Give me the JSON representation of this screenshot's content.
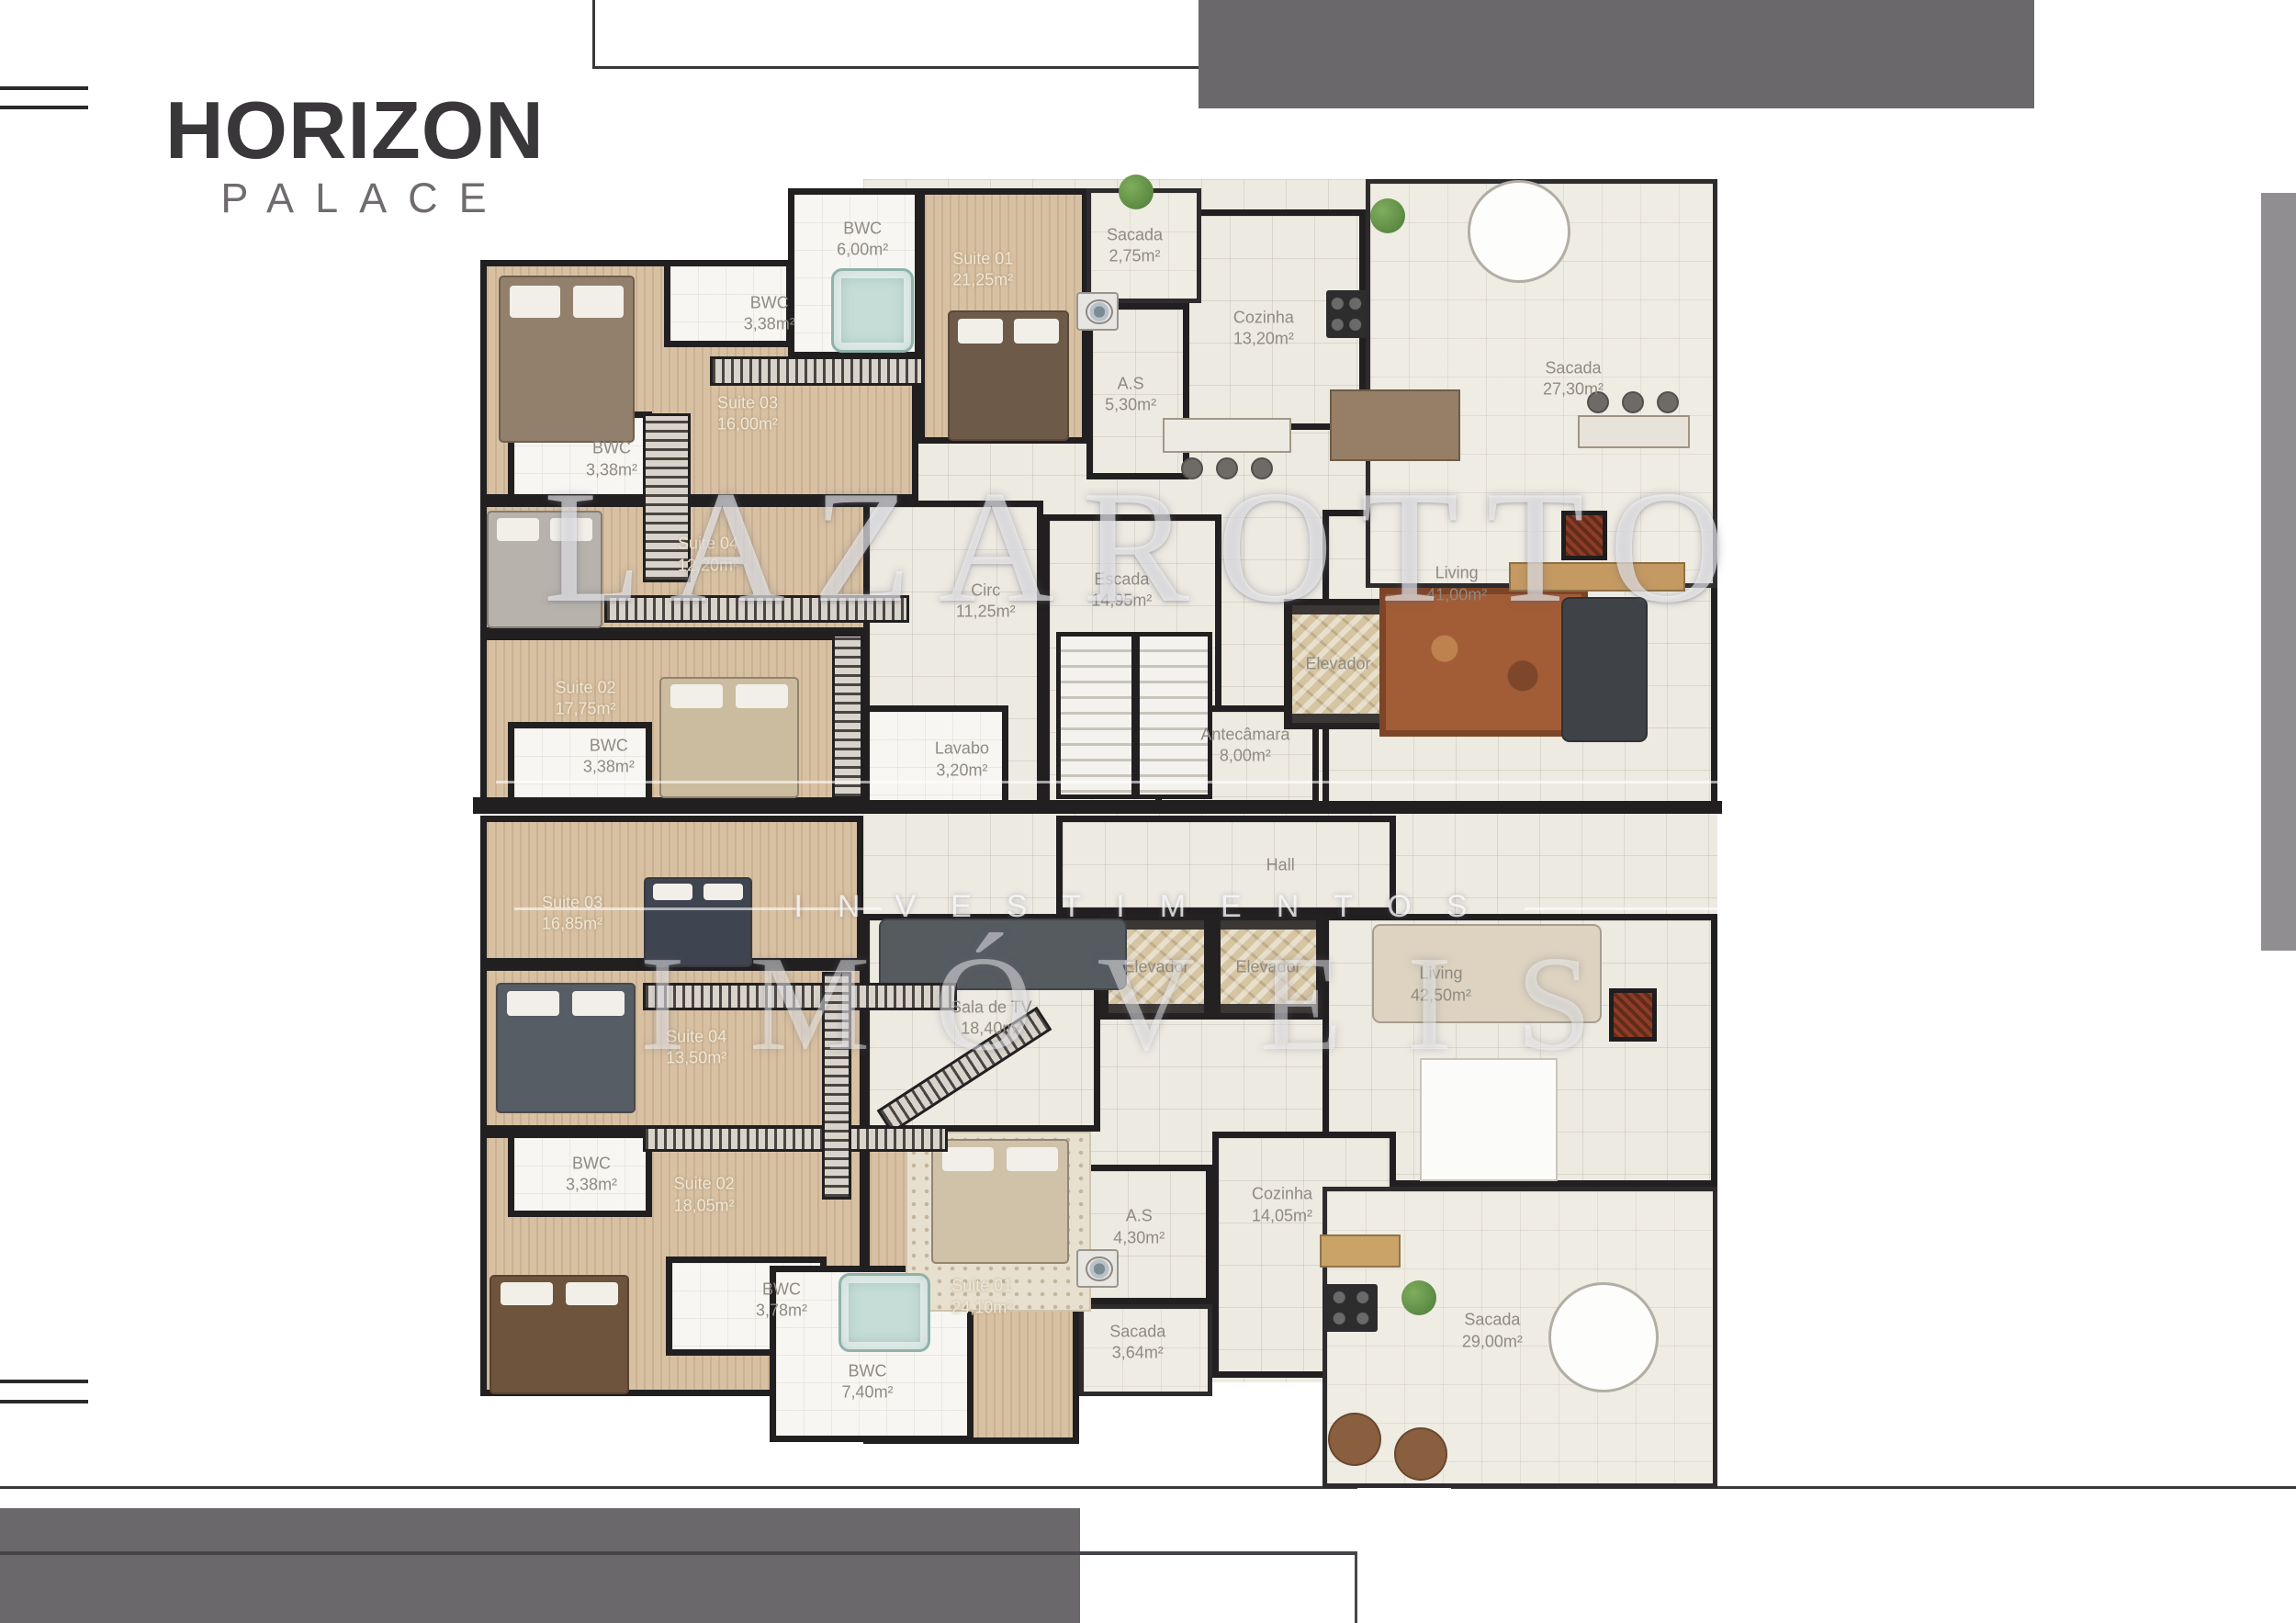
{
  "branding": {
    "title": "HORIZON",
    "subtitle": "PALACE"
  },
  "watermark": {
    "line1": "LAZAROTTO",
    "line2": "INVESTIMENTOS",
    "line3": "IMÓVEIS"
  },
  "colors": {
    "wall": "#211f20",
    "wood_floor": "#d8c1a3",
    "tile_floor": "#edeae2",
    "gray_bar": "#6b686b",
    "rule_line": "#3a373a",
    "label_gray": "#8f8b83",
    "label_cream": "#efe7d6"
  },
  "rooms": [
    {
      "name": "",
      "rect": [
        940,
        195,
        930,
        1310
      ],
      "floor": "tile",
      "noborder": true
    },
    {
      "name": "Suite 03",
      "area": "16,00m²",
      "rect": [
        523,
        283,
        477,
        262
      ],
      "floor": "wood",
      "label": "light",
      "label_at": [
        61,
        64
      ]
    },
    {
      "name": "Suite 04",
      "area": "12,20m²",
      "rect": [
        523,
        545,
        477,
        145
      ],
      "floor": "wood",
      "label": "light",
      "label_at": [
        52,
        41
      ]
    },
    {
      "name": "Suite 02",
      "area": "17,75m²",
      "rect": [
        523,
        690,
        477,
        186
      ],
      "floor": "wood",
      "label": "light",
      "label_at": [
        24,
        38
      ]
    },
    {
      "name": "Suite 01",
      "area": "21,25m²",
      "rect": [
        1000,
        205,
        185,
        278
      ],
      "floor": "wood",
      "label": "light",
      "label_at": [
        38,
        32
      ]
    },
    {
      "name": "Suite 03",
      "area": "16,85m²",
      "rect": [
        523,
        888,
        417,
        162
      ],
      "floor": "wood",
      "label": "light",
      "label_at": [
        24,
        66
      ]
    },
    {
      "name": "Suite 04",
      "area": "13,50m²",
      "rect": [
        523,
        1050,
        420,
        182
      ],
      "floor": "wood",
      "label": "light",
      "label_at": [
        56,
        50
      ]
    },
    {
      "name": "Suite 02",
      "area": "18,05m²",
      "rect": [
        523,
        1232,
        420,
        288
      ],
      "floor": "wood",
      "label": "light",
      "label_at": [
        58,
        24
      ]
    },
    {
      "name": "Suite 01",
      "area": "24,10m²",
      "rect": [
        940,
        1232,
        235,
        340
      ],
      "floor": "wood",
      "label": "light",
      "label_at": [
        55,
        53
      ]
    },
    {
      "name": "Cozinha",
      "area": "13,20m²",
      "rect": [
        1240,
        228,
        247,
        240
      ],
      "floor": "tile",
      "label_at": [
        55,
        54
      ]
    },
    {
      "name": "A.S",
      "area": "5,30m²",
      "rect": [
        1183,
        330,
        112,
        192
      ],
      "floor": "tile",
      "label_at": [
        43,
        52
      ]
    },
    {
      "name": "Living",
      "area": "41,00m²",
      "rect": [
        1440,
        555,
        430,
        325
      ],
      "floor": "tile",
      "label_at": [
        34,
        25
      ]
    },
    {
      "name": "Circ",
      "area": "11,25m²",
      "rect": [
        940,
        545,
        196,
        333
      ],
      "floor": "tile",
      "label_at": [
        68,
        33
      ]
    },
    {
      "name": "Escada",
      "area": "14,95m²",
      "rect": [
        1136,
        560,
        194,
        318
      ],
      "floor": "tile",
      "label_at": [
        44,
        26
      ]
    },
    {
      "name": "Antecâmara",
      "area": "8,00m²",
      "rect": [
        1258,
        768,
        178,
        110
      ],
      "floor": "tile",
      "label_at": [
        55,
        40
      ]
    },
    {
      "name": "Hall",
      "area": "",
      "rect": [
        1150,
        888,
        370,
        107
      ],
      "floor": "tile",
      "label_at": [
        66,
        50
      ]
    },
    {
      "name": "Living",
      "area": "42,50m²",
      "rect": [
        1440,
        995,
        430,
        297
      ],
      "floor": "tile",
      "label_at": [
        30,
        26
      ]
    },
    {
      "name": "Sala de TV",
      "area": "18,40m²",
      "rect": [
        940,
        995,
        258,
        237
      ],
      "floor": "tile",
      "label_at": [
        54,
        48
      ]
    },
    {
      "name": "A.S",
      "area": "4,30m²",
      "rect": [
        1175,
        1268,
        145,
        152
      ],
      "floor": "tile",
      "label_at": [
        45,
        45
      ]
    },
    {
      "name": "Cozinha",
      "area": "14,05m²",
      "rect": [
        1320,
        1232,
        200,
        268
      ],
      "floor": "tile",
      "label_at": [
        38,
        30
      ]
    },
    {
      "name": "Sacada",
      "area": "2,75m²",
      "rect": [
        1183,
        205,
        125,
        125
      ],
      "floor": "balcony",
      "label_at": [
        42,
        50
      ]
    },
    {
      "name": "Sacada",
      "area": "27,30m²",
      "rect": [
        1487,
        195,
        383,
        445
      ],
      "floor": "balcony",
      "label_at": [
        59,
        49
      ]
    },
    {
      "name": "Sacada",
      "area": "3,64m²",
      "rect": [
        1175,
        1420,
        145,
        100
      ],
      "floor": "balcony",
      "label_at": [
        44,
        42
      ]
    },
    {
      "name": "Sacada",
      "area": "29,00m²",
      "rect": [
        1440,
        1292,
        430,
        328
      ],
      "floor": "balcony",
      "label_at": [
        43,
        48
      ]
    },
    {
      "name": "BWC",
      "area": "6,00m²",
      "rect": [
        858,
        205,
        145,
        185
      ],
      "floor": "bwc",
      "label_at": [
        56,
        30
      ]
    },
    {
      "name": "BWC",
      "area": "3,38m²",
      "rect": [
        723,
        283,
        140,
        95
      ],
      "floor": "bwc",
      "label_at": [
        82,
        62
      ]
    },
    {
      "name": "BWC",
      "area": "3,38m²",
      "rect": [
        553,
        448,
        157,
        97
      ],
      "floor": "bwc",
      "label_at": [
        72,
        54
      ]
    },
    {
      "name": "BWC",
      "area": "3,38m²",
      "rect": [
        553,
        786,
        157,
        90
      ],
      "floor": "bwc",
      "label_at": [
        70,
        42
      ]
    },
    {
      "name": "Lavabo",
      "area": "3,20m²",
      "rect": [
        940,
        768,
        158,
        110
      ],
      "floor": "bwc",
      "label_at": [
        68,
        54
      ]
    },
    {
      "name": "BWC",
      "area": "3,38m²",
      "rect": [
        553,
        1232,
        157,
        93
      ],
      "floor": "bwc",
      "label_at": [
        58,
        50
      ]
    },
    {
      "name": "BWC",
      "area": "3,78m²",
      "rect": [
        725,
        1368,
        175,
        108
      ],
      "floor": "bwc",
      "label_at": [
        72,
        44
      ]
    },
    {
      "name": "BWC",
      "area": "7,40m²",
      "rect": [
        838,
        1378,
        222,
        192
      ],
      "floor": "bwc",
      "label_at": [
        48,
        66
      ]
    },
    {
      "name": "Elevador",
      "rect": [
        1398,
        652,
        118,
        142
      ],
      "type": "elevator"
    },
    {
      "name": "Elevador",
      "rect": [
        1198,
        995,
        122,
        115
      ],
      "type": "elevator"
    },
    {
      "name": "Elevador",
      "rect": [
        1320,
        995,
        122,
        115
      ],
      "type": "elevator"
    }
  ],
  "furniture": [
    {
      "t": "wall",
      "r": [
        515,
        868,
        430,
        18
      ]
    },
    {
      "t": "wall",
      "r": [
        935,
        872,
        940,
        14
      ]
    },
    {
      "t": "bed",
      "r": [
        543,
        300,
        148,
        182
      ],
      "c": "#93806c"
    },
    {
      "t": "bed",
      "r": [
        1032,
        338,
        132,
        142
      ],
      "c": "#6e5a48"
    },
    {
      "t": "bed",
      "r": [
        530,
        556,
        126,
        128
      ],
      "c": "#b7b2ac"
    },
    {
      "t": "bed",
      "r": [
        718,
        737,
        152,
        132
      ],
      "c": "#cbbc9f"
    },
    {
      "t": "jacuzzi",
      "r": [
        905,
        292,
        90,
        92
      ]
    },
    {
      "t": "stairs",
      "r": [
        1150,
        688,
        170,
        182
      ]
    },
    {
      "t": "rug",
      "r": [
        1502,
        640,
        227,
        162
      ]
    },
    {
      "t": "sofa",
      "r": [
        1700,
        650,
        94,
        158
      ],
      "c": "#3f4347"
    },
    {
      "t": "round",
      "r": [
        1598,
        196,
        112,
        112
      ]
    },
    {
      "t": "counter",
      "r": [
        1718,
        452,
        122,
        36
      ],
      "c": "#e7e3da"
    },
    {
      "t": "stool",
      "r": [
        1728,
        426,
        24,
        24
      ]
    },
    {
      "t": "stool",
      "r": [
        1766,
        426,
        24,
        24
      ]
    },
    {
      "t": "stool",
      "r": [
        1804,
        426,
        24,
        24
      ]
    },
    {
      "t": "fire",
      "r": [
        1700,
        556,
        50,
        54
      ]
    },
    {
      "t": "counter",
      "r": [
        1643,
        612,
        192,
        32
      ],
      "c": "#c49a62"
    },
    {
      "t": "table",
      "r": [
        1448,
        424,
        142,
        78
      ]
    },
    {
      "t": "counter",
      "r": [
        1266,
        455,
        140,
        38
      ],
      "c": "#eceae3"
    },
    {
      "t": "stool",
      "r": [
        1286,
        498,
        24,
        24
      ]
    },
    {
      "t": "stool",
      "r": [
        1324,
        498,
        24,
        24
      ]
    },
    {
      "t": "stool",
      "r": [
        1362,
        498,
        24,
        24
      ]
    },
    {
      "t": "stove",
      "r": [
        1444,
        316,
        44,
        52
      ]
    },
    {
      "t": "washer",
      "r": [
        1172,
        318,
        46,
        42
      ]
    },
    {
      "t": "plant",
      "r": [
        1218,
        190,
        38,
        38
      ]
    },
    {
      "t": "plant",
      "r": [
        1492,
        216,
        38,
        38
      ]
    },
    {
      "t": "hatch",
      "r": [
        773,
        388,
        233,
        32
      ]
    },
    {
      "t": "hatch",
      "r": [
        700,
        450,
        52,
        184
      ],
      "v": 1
    },
    {
      "t": "hatch",
      "r": [
        658,
        648,
        332,
        30
      ]
    },
    {
      "t": "hatch",
      "r": [
        906,
        690,
        34,
        180
      ],
      "v": 1
    },
    {
      "t": "bed",
      "r": [
        701,
        955,
        118,
        98
      ],
      "c": "#3e4450"
    },
    {
      "t": "bed",
      "r": [
        540,
        1070,
        152,
        142
      ],
      "c": "#575d64"
    },
    {
      "t": "bed",
      "r": [
        533,
        1388,
        152,
        130
      ],
      "c": "#6e543c"
    },
    {
      "t": "rugdot",
      "r": [
        986,
        1232,
        202,
        196
      ]
    },
    {
      "t": "bed",
      "r": [
        1014,
        1240,
        150,
        136
      ],
      "c": "#cfc2a8"
    },
    {
      "t": "jacuzzi",
      "r": [
        913,
        1386,
        100,
        86
      ]
    },
    {
      "t": "sofa",
      "r": [
        957,
        1000,
        270,
        78
      ],
      "c": "#565b60"
    },
    {
      "t": "hatch",
      "r": [
        946,
        1150,
        208,
        30
      ],
      "rot": -33
    },
    {
      "t": "sofa",
      "r": [
        1494,
        1006,
        250,
        108
      ],
      "c": "#ddd3c0"
    },
    {
      "t": "tablew",
      "r": [
        1546,
        1152,
        150,
        134
      ]
    },
    {
      "t": "fire",
      "r": [
        1752,
        1076,
        52,
        58
      ]
    },
    {
      "t": "stove",
      "r": [
        1442,
        1398,
        58,
        52
      ]
    },
    {
      "t": "counter",
      "r": [
        1437,
        1344,
        88,
        36
      ],
      "c": "#c9a368"
    },
    {
      "t": "round",
      "r": [
        1686,
        1396,
        120,
        120
      ]
    },
    {
      "t": "stool",
      "r": [
        1446,
        1538,
        58,
        58
      ],
      "c": "#8a5f3f"
    },
    {
      "t": "stool",
      "r": [
        1518,
        1554,
        58,
        58
      ],
      "c": "#8a5f3f"
    },
    {
      "t": "plant",
      "r": [
        1526,
        1394,
        38,
        38
      ]
    },
    {
      "t": "washer",
      "r": [
        1172,
        1360,
        46,
        42
      ]
    },
    {
      "t": "hatch",
      "r": [
        700,
        1070,
        342,
        30
      ]
    },
    {
      "t": "hatch",
      "r": [
        700,
        1226,
        332,
        28
      ]
    },
    {
      "t": "hatch",
      "r": [
        895,
        1058,
        32,
        248
      ],
      "v": 1
    }
  ]
}
